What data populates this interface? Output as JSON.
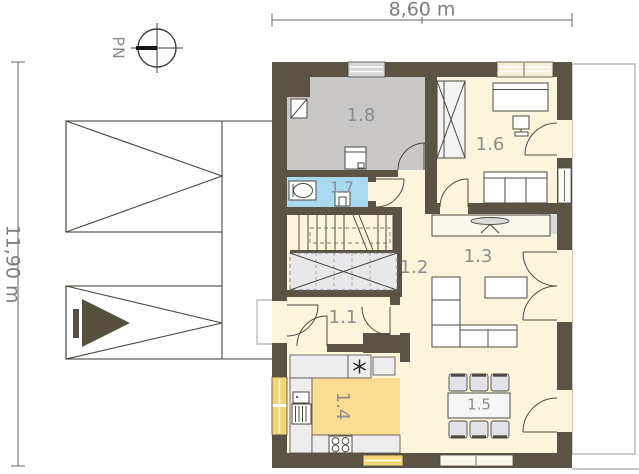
{
  "dimensions": {
    "width": "8,60 m",
    "height": "11,90 m"
  },
  "compass": {
    "label": "PN"
  },
  "rooms": [
    {
      "number": "1.1"
    },
    {
      "number": "1.2"
    },
    {
      "number": "1.3"
    },
    {
      "number": "1.4"
    },
    {
      "number": "1.5"
    },
    {
      "number": "1.6"
    },
    {
      "number": "1.7"
    },
    {
      "number": "1.8"
    }
  ],
  "colors": {
    "wall": "#5b5445",
    "floor": "#fcf5dc",
    "room_1_8_fill": "#c9c8c6",
    "room_1_7_fill": "#a9daf1",
    "room_1_4_fill": "#fbdc92",
    "window_yellow": "#f5d478",
    "counter_gray": "#ededee",
    "label_gray": "#8c8c8c"
  }
}
